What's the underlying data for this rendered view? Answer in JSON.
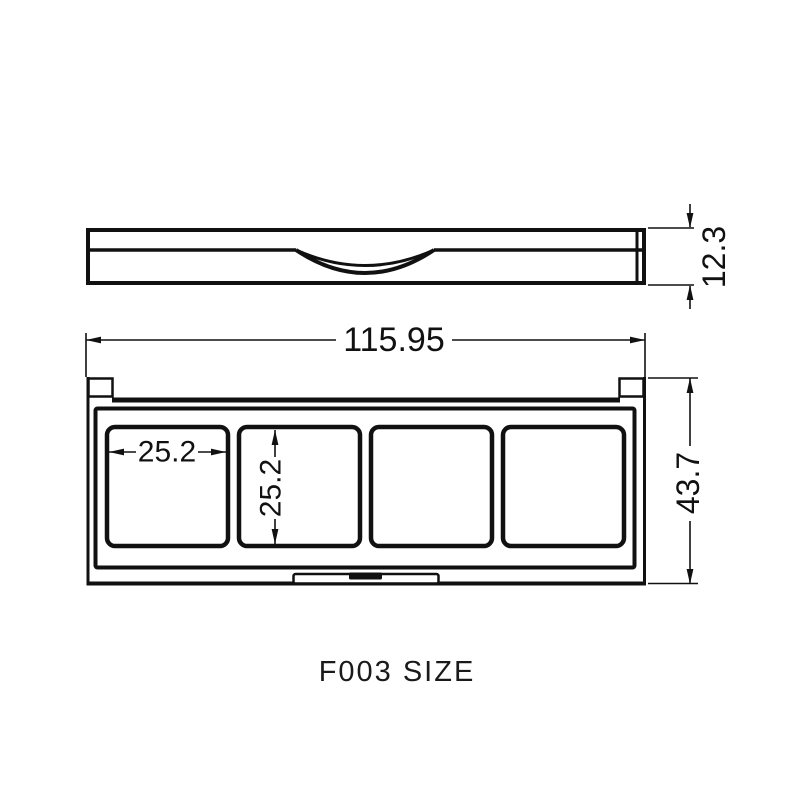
{
  "title": "F003 SIZE",
  "drawing": {
    "side_view": {
      "name": "palette closed side profile",
      "thickness_dim": "12.3"
    },
    "top_view": {
      "name": "palette open top view with four pans",
      "overall_width_dim": "115.95",
      "overall_depth_dim": "43.7",
      "pan_width_dim": "25.2",
      "pan_height_dim": "25.2",
      "pan_count": 4
    }
  },
  "colors": {
    "line": "#111111",
    "background": "#ffffff"
  }
}
